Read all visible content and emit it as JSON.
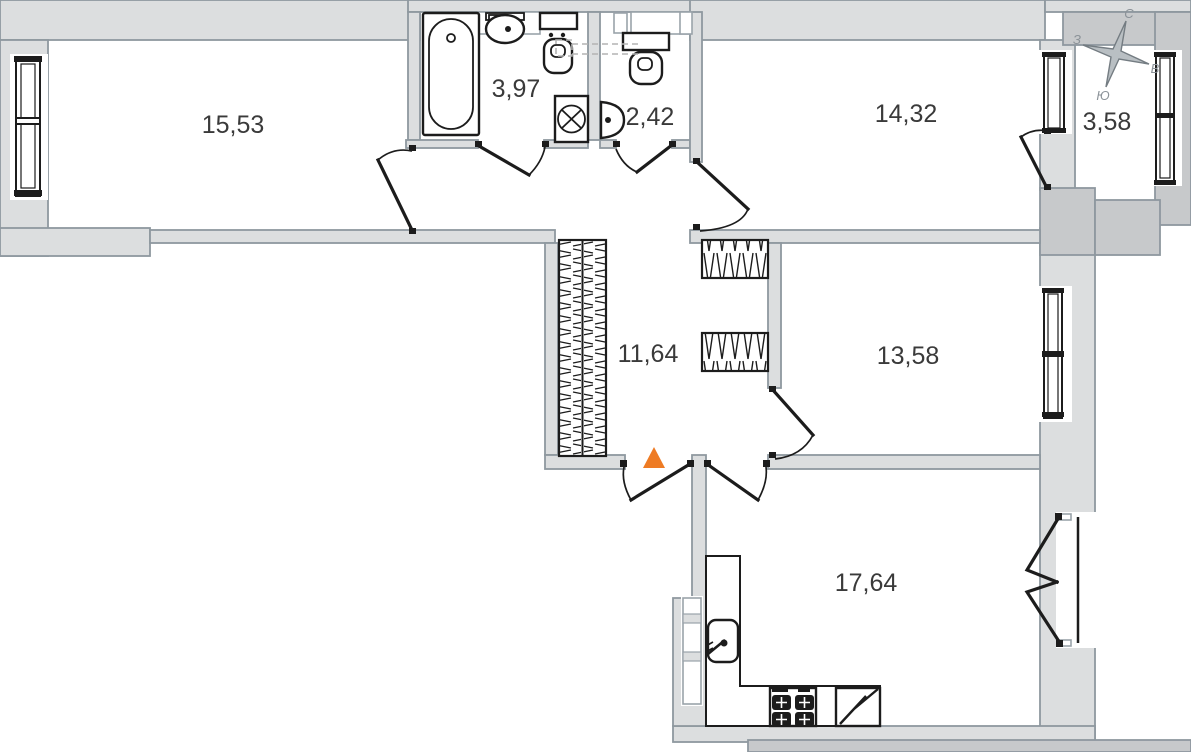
{
  "areas": {
    "room_top_left": "15,53",
    "bathroom": "3,97",
    "wc": "2,42",
    "room_top_right": "14,32",
    "balcony": "3,58",
    "hallway": "11,64",
    "room_middle_right": "13,58",
    "kitchen": "17,64"
  },
  "compass": {
    "north": "С",
    "south": "Ю",
    "west": "З",
    "east": "В"
  },
  "colors": {
    "wall_fill": "#dcdedf",
    "outer_wall_fill": "#c7c9cb",
    "wall_stroke": "#8e989f",
    "line": "#1c1c1c",
    "entrance_marker": "#ee7b24"
  },
  "symbols": [
    "bathtub",
    "washbasin",
    "toilet",
    "washing-machine",
    "hand-sink",
    "wardrobe",
    "kitchen-sink",
    "gas-stove",
    "refrigerator",
    "entrance-marker",
    "compass-rose",
    "window",
    "door"
  ]
}
